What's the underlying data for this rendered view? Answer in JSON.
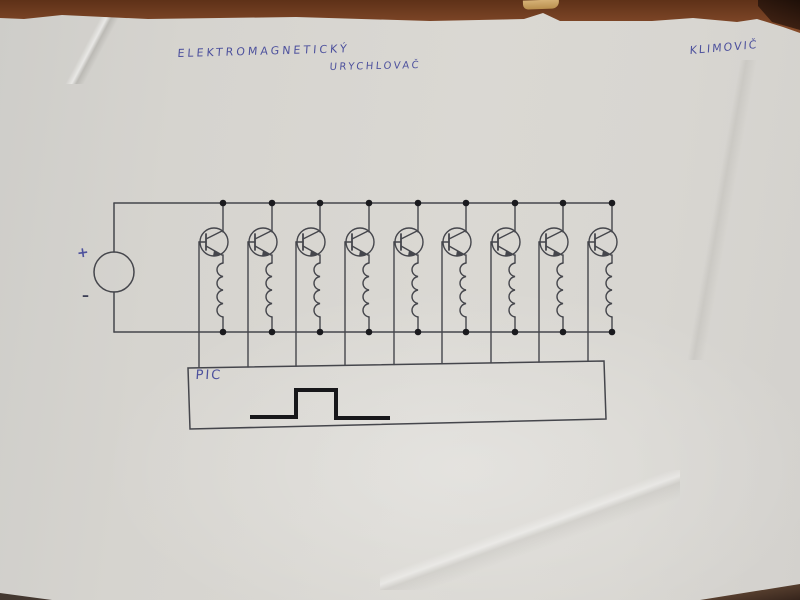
{
  "annotations": {
    "title_line1": "ELEKTROMAGNETICKÝ",
    "title_line2": "URYCHLOVAČ",
    "author": "KLIMOVIČ",
    "pic_label": "PIC",
    "source_plus": "+",
    "source_minus": "–"
  },
  "colors": {
    "paper": "#d6d4cf",
    "table_wood": "#7c4526",
    "ink": "#45464c",
    "junction_dot": "#1a1a1e",
    "pen_blue": "#4d519d",
    "pulse_black": "#17171a"
  },
  "circuit": {
    "stage_count": 9,
    "stage_xs": [
      223,
      272,
      320,
      369,
      418,
      466,
      515,
      563,
      612
    ],
    "rails": {
      "top_y": 203,
      "bottom_y": 332,
      "left_x": 114,
      "right_x": 613
    },
    "source": {
      "cx": 114,
      "cy": 272,
      "r": 20
    },
    "transistor": {
      "center_dx": -9,
      "center_y": 242,
      "r": 14
    },
    "coil": {
      "top_y": 263,
      "bump_h": 13.5,
      "bumps": 4
    },
    "base_drop_dx": -24,
    "pic_box": {
      "polygon": [
        [
          188,
          368
        ],
        [
          604,
          361
        ],
        [
          606,
          419
        ],
        [
          190,
          429
        ]
      ]
    },
    "pulse": {
      "points": [
        [
          252,
          417
        ],
        [
          296,
          417
        ],
        [
          296,
          390
        ],
        [
          336,
          390
        ],
        [
          336,
          418
        ],
        [
          388,
          418
        ]
      ],
      "stroke_width": 4
    }
  }
}
